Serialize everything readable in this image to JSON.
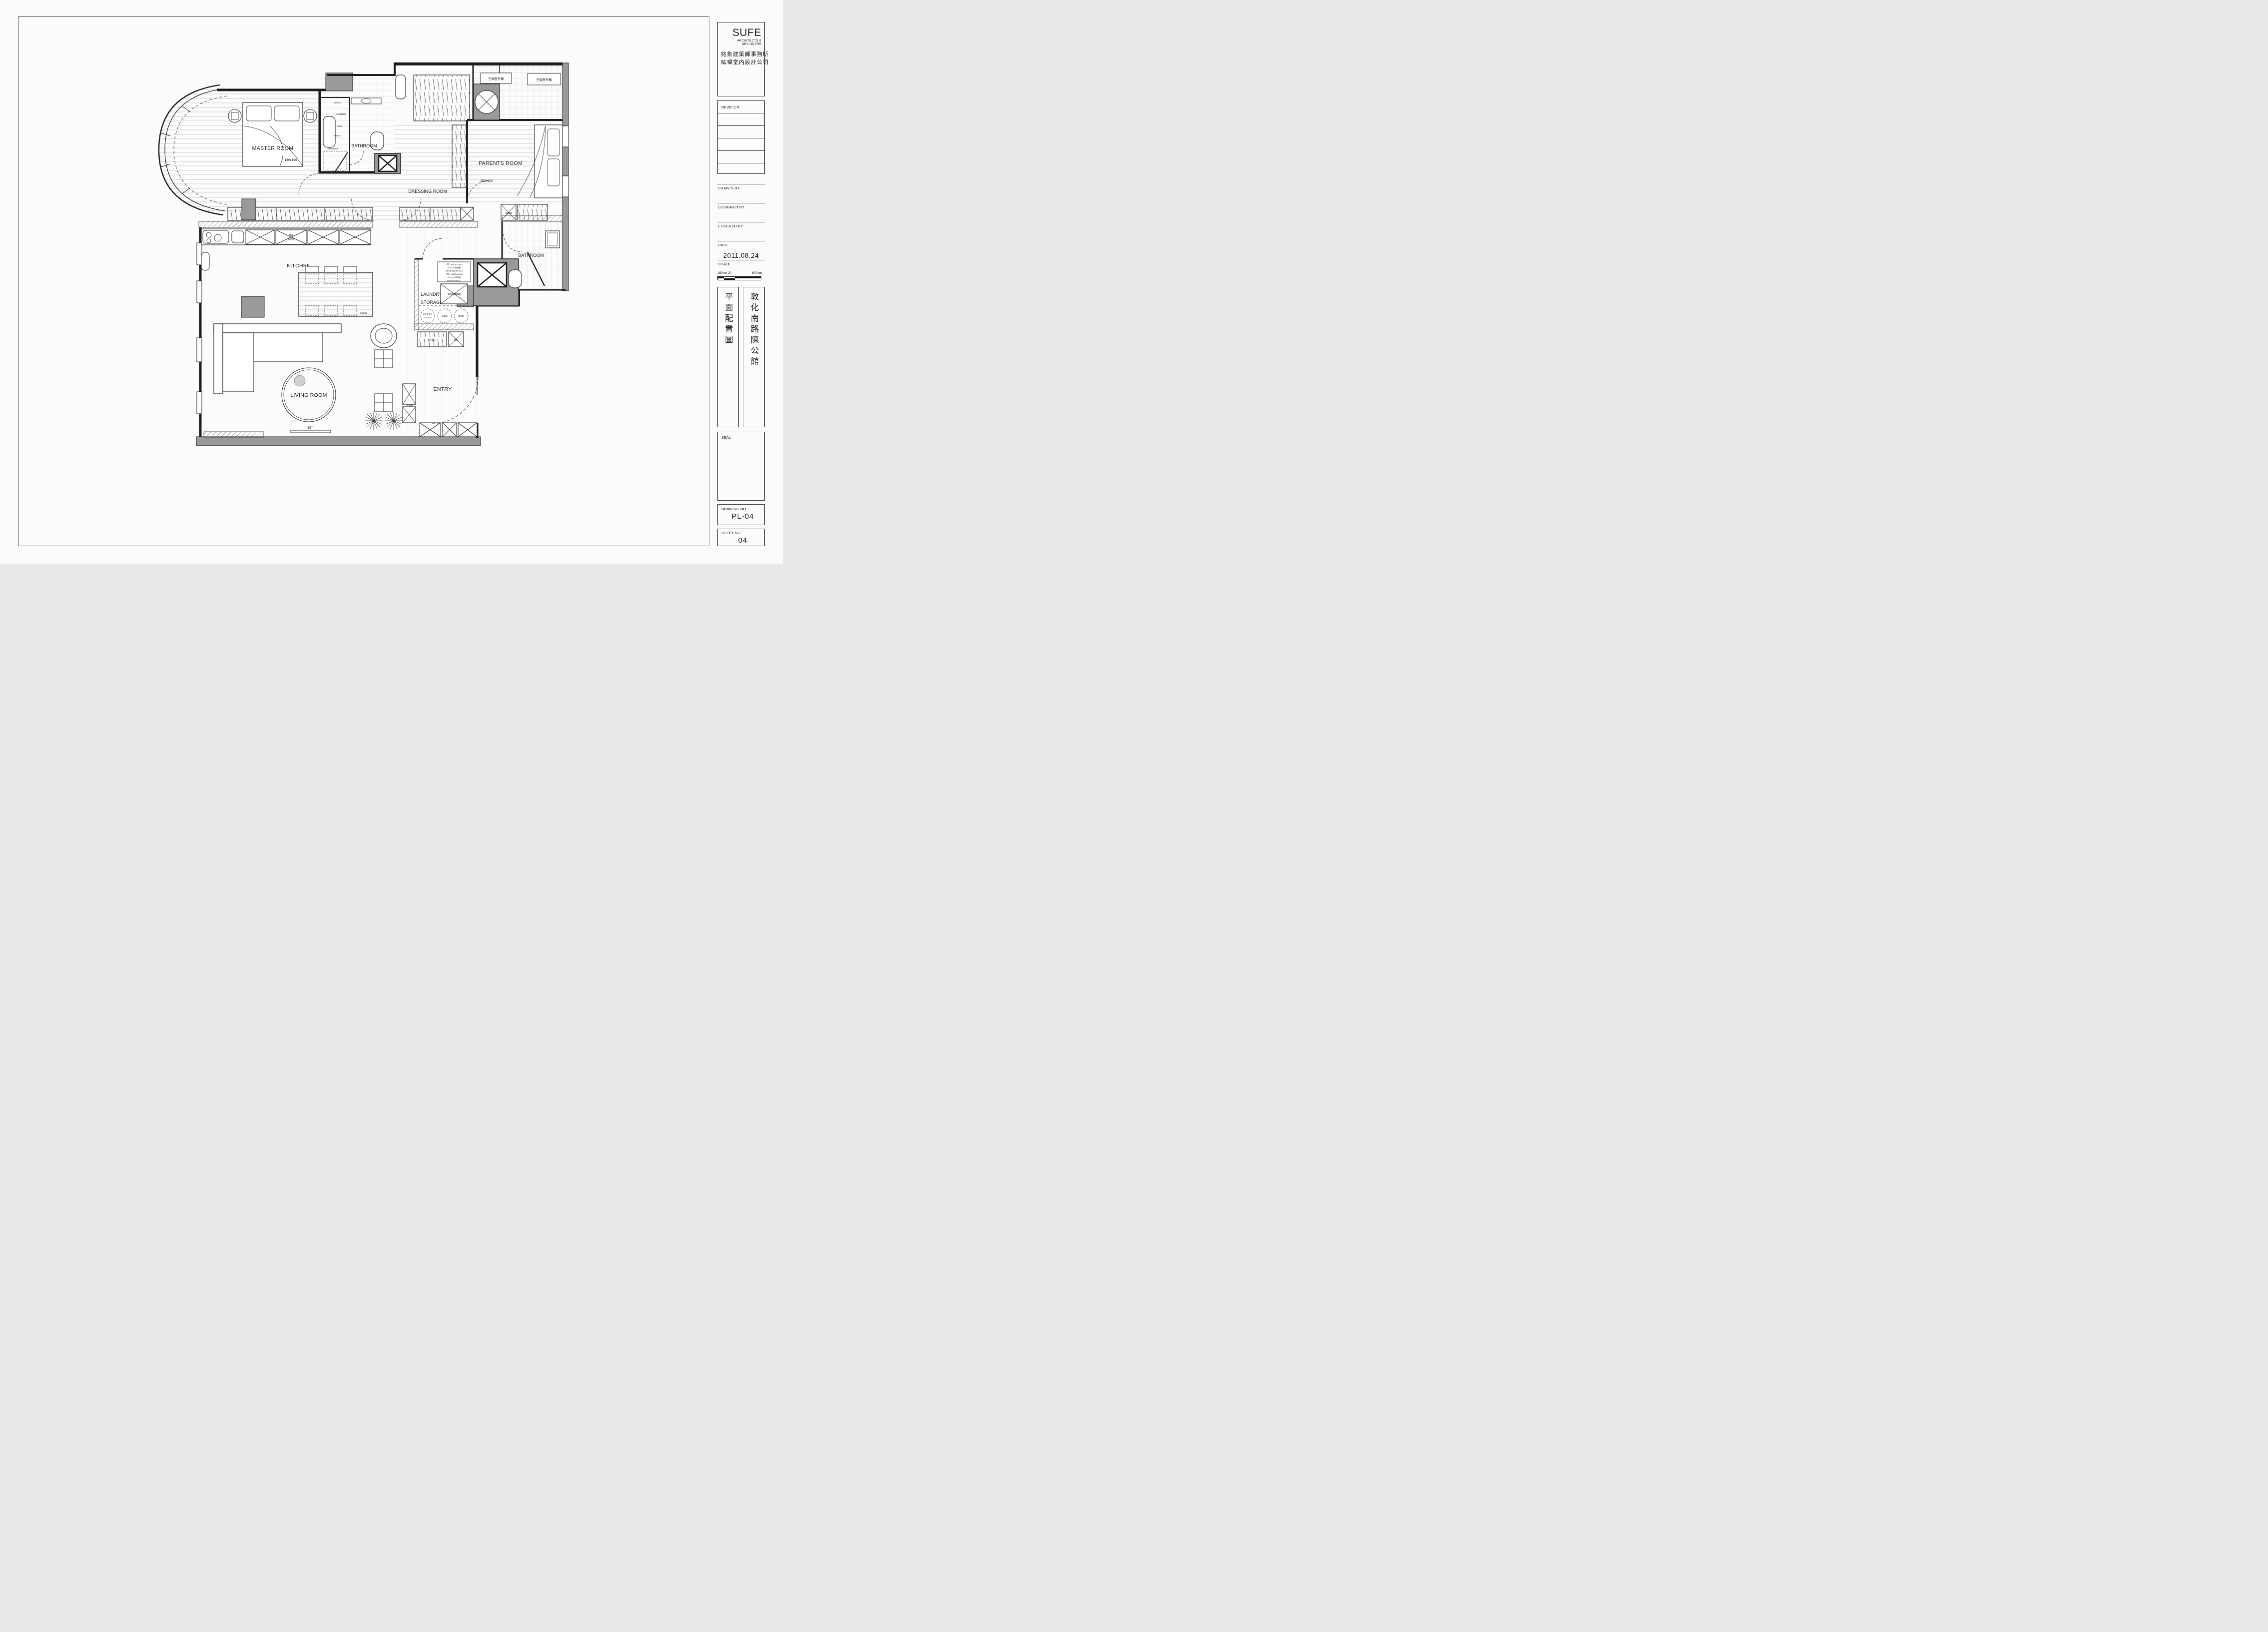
{
  "titleblock": {
    "logo": {
      "name": "SUFE",
      "subtitle": "ARCHITECTS & DESIGNERS",
      "cn_line1": "銘象建築師事務所",
      "cn_line2": "紘幃室內設計公司"
    },
    "revision_label": "REVISION",
    "drawn_by_label": "DRAWIN BY",
    "designed_by_label": "DESIGNED BY",
    "checked_by_label": "CHECKED BY",
    "date_label": "DATE",
    "date_value": "2011.08.24",
    "scale_label": "SCALE",
    "scale_left": "100cm 30",
    "scale_right": "600cm",
    "project_type_vertical": "平面配置圖",
    "project_name_vertical": "敦化南路陳公館",
    "seal_label": "SEAL",
    "drawing_no_label": "DRAWING NO",
    "drawing_no_value": "PL-04",
    "sheet_no_label": "SHEET NO",
    "sheet_no_value": "04"
  },
  "plan": {
    "labels": {
      "master_room": "MASTER ROOM",
      "master_bed_size": "180x190",
      "bathtub": "BATHTUB",
      "shower": "SHOWER",
      "bathroom_master": "BATHROOM",
      "dressing_room": "DRESSING ROOM",
      "parents_room": "PARENTS ROOM",
      "parents_bed_size": "150x190",
      "kitchen": "KITCHEN",
      "laundry_line1": "LAUNDRY &",
      "laundry_line2": "STORAGE",
      "bathroom_guest": "BATHROOM",
      "living_room": "LIVING ROOM",
      "entry": "ENTRY",
      "ac_outdoor_1": "空調室外機",
      "ac_outdoor_2": "空調室外機",
      "oven_line1": "烤箱",
      "oven_line2": "紅酒櫃",
      "ref_1": "REF",
      "ref_2": "REF",
      "dining_size": "200x80",
      "tv_size": "55\"",
      "tv_size_parents": "32\"",
      "equip_cabinet_1": "設備櫃",
      "equip_cabinet_2": "設備櫃",
      "golf": "GOLF",
      "umbrella_rack": "傘架",
      "phone_hub": "電話網路集線器",
      "iron_line1": "直立式熨斗",
      "iron_line2": "H:150cm",
      "vacuum": "吸塵器",
      "fan": "電風扇",
      "washer_l1": "上層：WTC82100TC",
      "washer_l2": "BOSCH 烘衣機",
      "washer_l3": "W59.9*D63.5*H84.2",
      "washer_l4": "下層：WAS24460UC",
      "washer_l5": "BOSCH 洗衣機",
      "washer_l6": "W60*D59*H84.2",
      "level_25": "+25cm",
      "level_0": "+0cm",
      "level_60": "+60cm"
    }
  }
}
